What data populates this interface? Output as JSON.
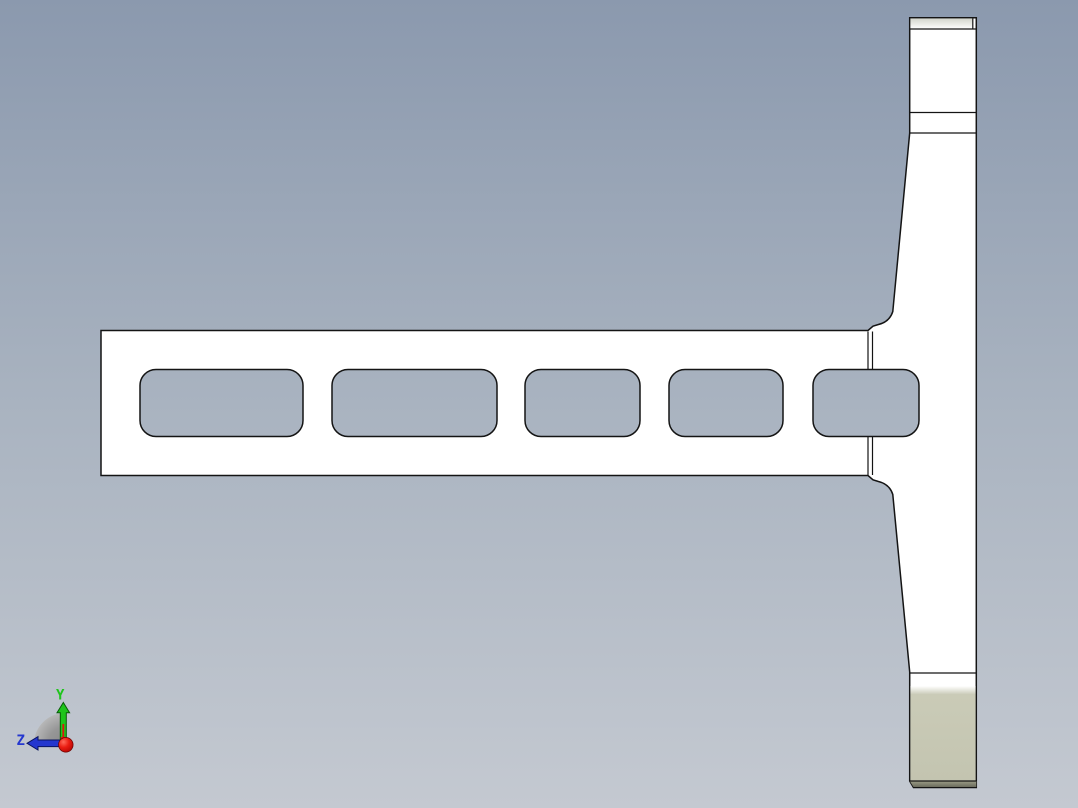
{
  "viewport": {
    "type": "cad-3d-viewport",
    "background": {
      "top": "#8b99ae",
      "middle": "#a9b3c0",
      "bottom": "#c4c9d1"
    },
    "part": {
      "description_colors": {
        "face_fill": "#ffffff",
        "outline": "#141414",
        "top_chamfer_light": "#d8dbd2",
        "bottom_face_tan": "#c7c8b4",
        "bottom_band_light": "#9b9c86",
        "bottom_band_dark": "#636455"
      },
      "slots": [
        {
          "x": 140,
          "y": 369.5,
          "w": 163,
          "h": 67,
          "r": 16
        },
        {
          "x": 332,
          "y": 369.5,
          "w": 165,
          "h": 67,
          "r": 16
        },
        {
          "x": 525,
          "y": 369.5,
          "w": 115,
          "h": 67,
          "r": 16
        },
        {
          "x": 669,
          "y": 369.5,
          "w": 114,
          "h": 67,
          "r": 16
        },
        {
          "x": 813,
          "y": 369.5,
          "w": 106,
          "h": 67,
          "r": 16
        }
      ],
      "blend_edges": {
        "x1": 868,
        "x2": 872.5,
        "upper_segment": [
          331.5,
          369.5
        ],
        "lower_segment": [
          436.5,
          475
        ]
      }
    },
    "triad": {
      "labels": {
        "y": "Y",
        "z": "Z"
      },
      "colors": {
        "x_axis": "#e01111",
        "y_axis": "#1ec41b",
        "z_axis": "#2437cf",
        "origin_ball": "#e01010",
        "sector": "#9a9a9a"
      }
    }
  }
}
